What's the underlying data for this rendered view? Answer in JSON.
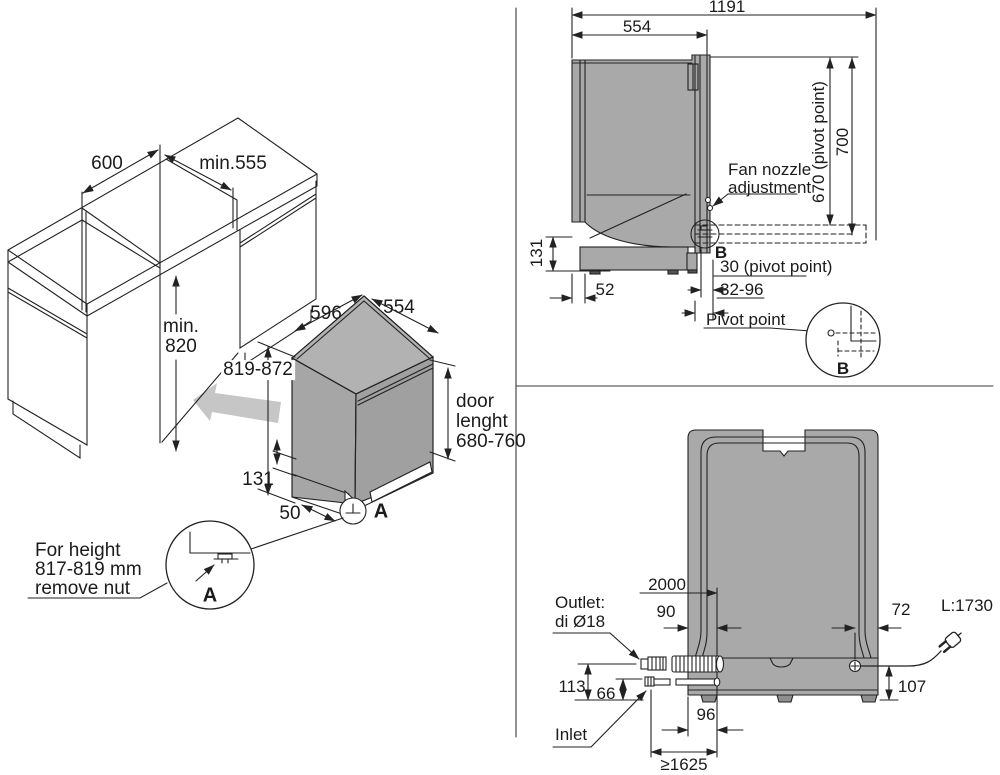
{
  "colors": {
    "body_gray": "#a9a9a9",
    "arrow_gray": "#c6c6c6",
    "line": "#222222",
    "background": "#ffffff"
  },
  "cabinet_panel": {
    "counter_depth": "600",
    "opening_width": "min.555",
    "opening_height_line1": "min.",
    "opening_height_line2": "820",
    "dw_width": "596",
    "dw_depth": "554",
    "dw_height": "819-872",
    "door_label_line1": "door",
    "door_label_line2": "lenght",
    "door_label_line3": "680-760",
    "base_height": "131",
    "foot_setback": "50",
    "detail_marker": "A",
    "detail_circle_label": "A",
    "note_line1": "For height",
    "note_line2": "817-819 mm",
    "note_line3": "remove nut"
  },
  "side_panel": {
    "total_depth_door_open": "1191",
    "dw_depth": "554",
    "fan_line1": "Fan nozzle",
    "fan_line2": "adjustment",
    "pivot_height": "670 (pivot point)",
    "door_open_height": "700",
    "base_height": "131",
    "back_offset": "52",
    "detail_marker": "B",
    "pivot_offset": "30 (pivot point)",
    "pivot_range": "32-96",
    "pivot_label": "Pivot point",
    "detail_circle_label": "B"
  },
  "rear_panel": {
    "outlet_line1": "Outlet:",
    "outlet_line2": "di Ø18",
    "outlet_hose_length": "2000",
    "outlet_offset": "90",
    "cord_offset": "72",
    "cord_length": "L:1730",
    "outlet_height": "113",
    "inlet_height": "66",
    "cord_height": "107",
    "inlet_offset": "96",
    "inlet_label": "Inlet",
    "inlet_hose_min_length": "≥1625"
  }
}
